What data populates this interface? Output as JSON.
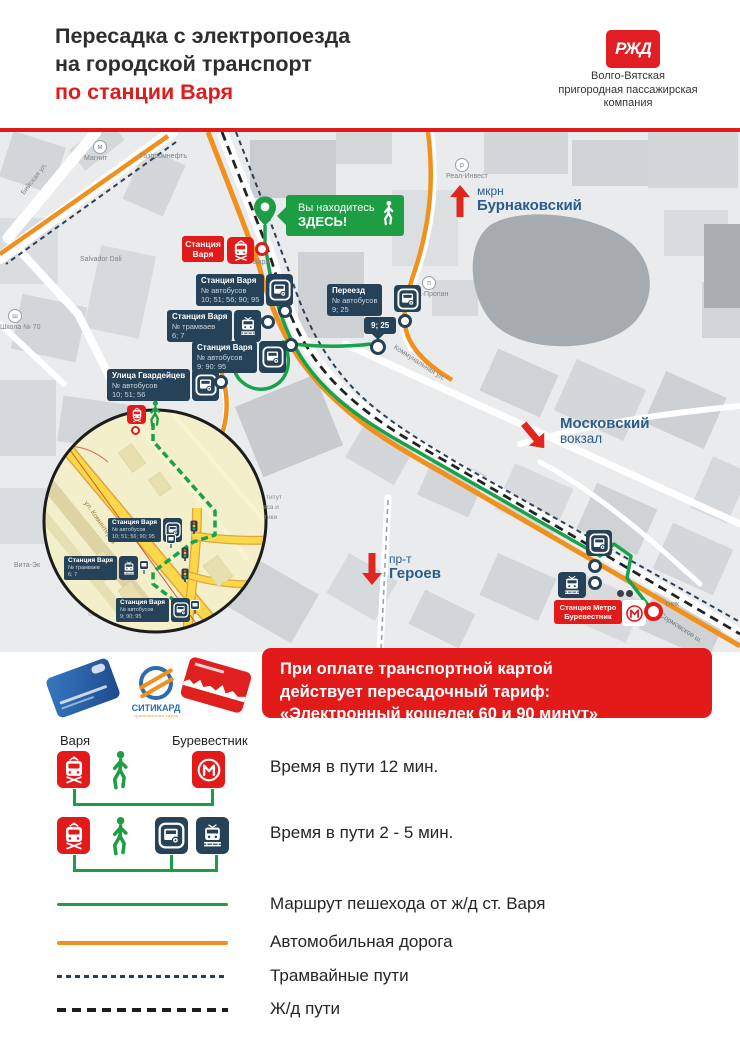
{
  "header": {
    "title": [
      "Пересадка с электропоезда",
      "на городской транспорт",
      "по станции Варя"
    ],
    "logo": "РЖД",
    "company": [
      "Волго-Вятская",
      "пригородная пассажирская",
      "компания"
    ]
  },
  "map": {
    "you_are_here": [
      "Вы находитесь",
      "ЗДЕСЬ!"
    ],
    "varya_box": [
      "Станция",
      "Варя"
    ],
    "varya_label": "Варя",
    "stops": [
      {
        "title": "Станция Варя",
        "sub": "№ автобусов",
        "nums": "10; 51; 56; 90; 95"
      },
      {
        "title": "Станция Варя",
        "sub": "№ трамваев",
        "nums": "6; 7"
      },
      {
        "title": "Станция Варя",
        "sub": "№ автобусов",
        "nums": "9; 90; 95"
      },
      {
        "title": "Улица Гвардейцев",
        "sub": "№ автобусов",
        "nums": "10; 51; 56"
      },
      {
        "title": "Переезд",
        "sub": "№ автобусов",
        "nums": "9; 25"
      }
    ],
    "small_stop": "9; 25",
    "metro_box": [
      "Станция Метро",
      "Буревестник"
    ],
    "metro_fragment": "тник",
    "areas": {
      "burnakovsky": [
        "мкрн",
        "Бурнаковский"
      ],
      "moskovsky": [
        "Московский",
        "вокзал"
      ],
      "geroev": [
        "пр-т",
        "Героев"
      ]
    },
    "poi": {
      "magnit": "Магнит",
      "gazprom": "Газпромнефть",
      "biyskaya": "Бийская ул.",
      "salvador": "Salvador Dali",
      "school": "Школа № 70",
      "real_invest": "Реал-Инвест",
      "propan": "А-Пропан",
      "kommunalnaya": "Коммунальная ул.",
      "sormovskoe": "Сормовское ш.",
      "vita": "Вита-Эк"
    },
    "inset": {
      "street": "ул. Коминтерна",
      "stops": [
        {
          "title": "Станция Варя",
          "sub": "№ автобусов",
          "nums": "10; 51; 56; 90; 95"
        },
        {
          "title": "Станция Варя",
          "sub": "№ трамваев",
          "nums": "6; 7"
        },
        {
          "title": "Станция Варя",
          "sub": "№ автобусов",
          "nums": "9; 90; 95"
        }
      ],
      "fragments": [
        "титут",
        "еса и",
        "тики"
      ]
    }
  },
  "banner": [
    "При оплате транспортной картой",
    "действует пересадочный тариф:",
    "«Электронный кошелек 60 и 90 минут»"
  ],
  "cards": {
    "citicard": "СИТИКАРД",
    "citicard_sub": "транспортная карта"
  },
  "legend": {
    "varya": "Варя",
    "burevestnik": "Буревестник",
    "time12": "Время в пути 12 мин.",
    "time25": "Время в пути 2 - 5 мин.",
    "walk": "Маршрут пешехода от ж/д ст. Варя",
    "road": "Автомобильная дорога",
    "tram": "Трамвайные пути",
    "rail": "Ж/д пути"
  },
  "colors": {
    "red": "#e21a1a",
    "green": "#1e9e44",
    "orange": "#f0911e",
    "navy": "#264258",
    "area_blue": "#2a5d8c"
  }
}
